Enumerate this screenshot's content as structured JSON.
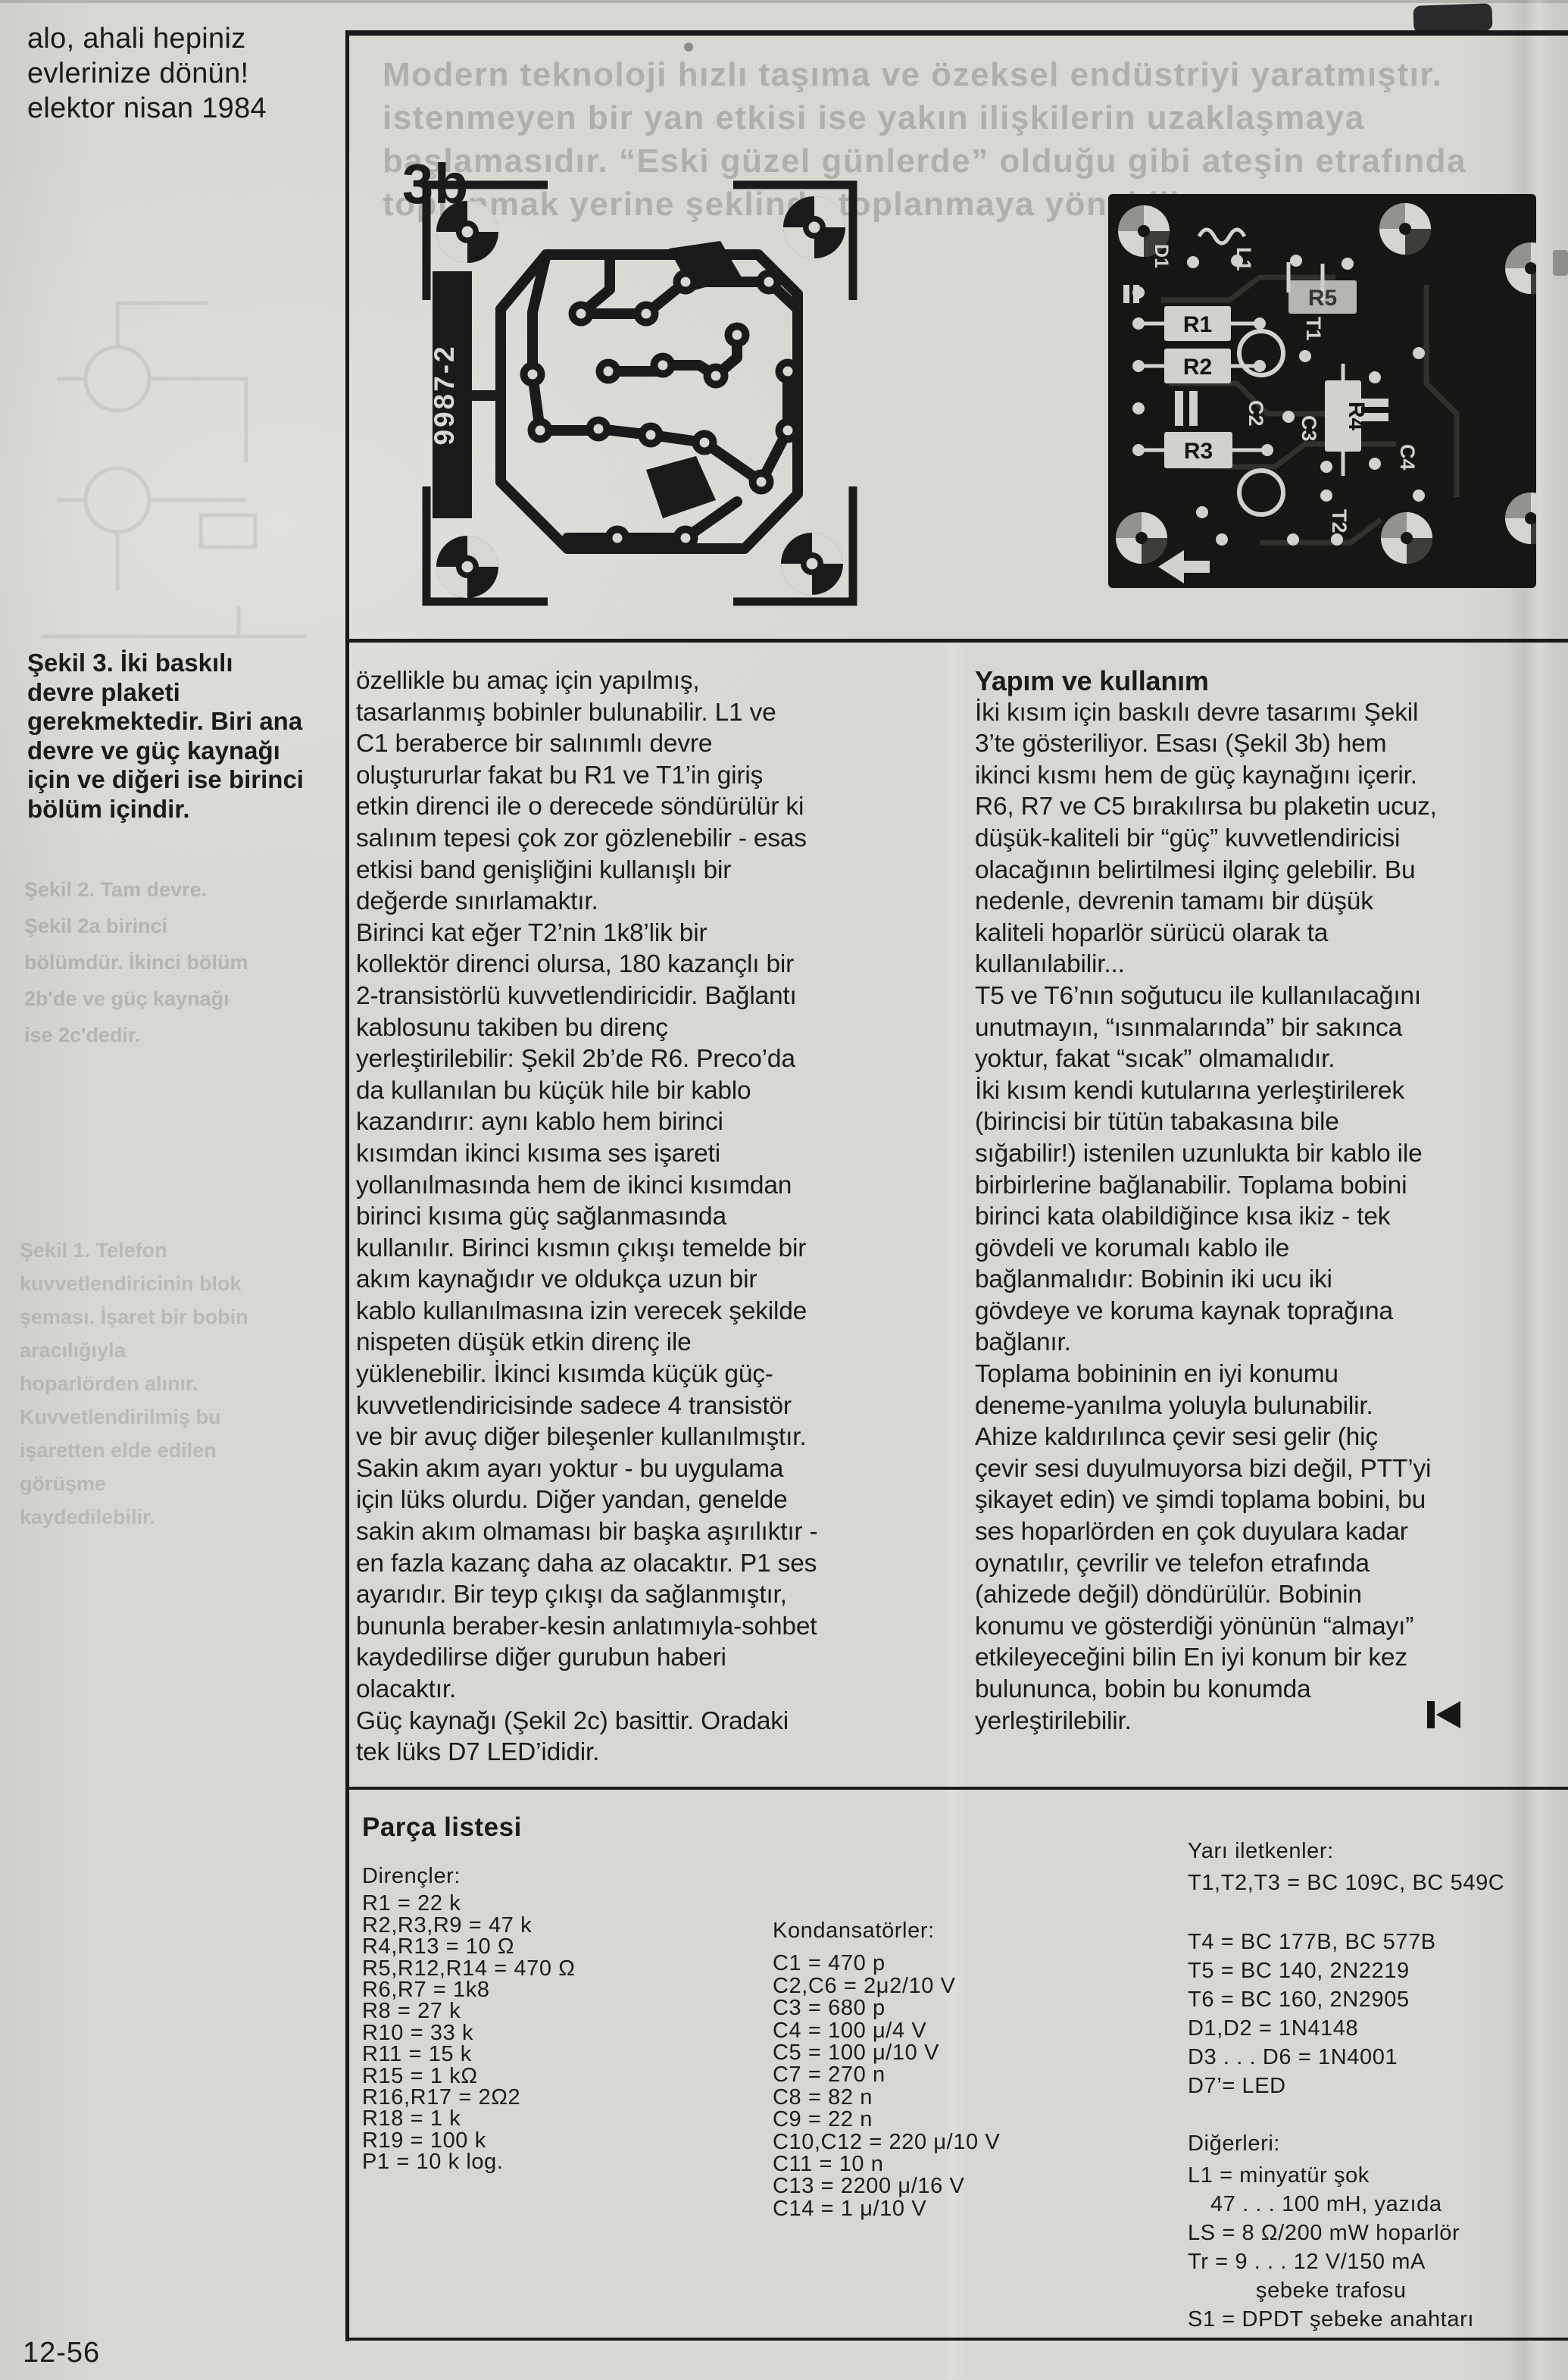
{
  "page": {
    "note_lines": [
      "alo, ahali hepiniz",
      "evlerinize dönün!",
      "elektor nisan 1984"
    ],
    "page_number": "12-56"
  },
  "ghost": {
    "top_lines": [
      "Modern teknoloji hızlı taşıma ve özeksel endüstriyi yaratmıştır.",
      "istenmeyen bir yan etkisi ise yakın ilişkilerin uzaklaşmaya",
      "başlamasıdır. “Eski güzel günlerde” olduğu gibi ateşin etrafında",
      "toplanmak yerine şeklinde toplanmaya yöneldik"
    ],
    "side_letter": "S",
    "margin_a_lines": [
      "Şekil 2. Tam devre.",
      "Şekil 2a birinci",
      "bölümdür. İkinci bölüm",
      "2b'de ve güç kaynağı",
      "ise 2c'dedir."
    ],
    "margin_b_lines": [
      "Şekil 1. Telefon",
      "kuvvetlendiricinin blok",
      "şeması. İşaret bir bobin",
      "aracılığıyla",
      "hoparlörden alınır.",
      "Kuvvetlendirilmiş bu",
      "işaretten elde edilen",
      "görüşme",
      "kaydedilebilir."
    ]
  },
  "figure": {
    "label": "3b",
    "board_code": "9987-2",
    "photo": {
      "r1": "R1",
      "r2": "R2",
      "r3": "R3",
      "r4": "R4",
      "r5": "R5",
      "c2": "C2",
      "c3": "C3",
      "c4": "C4",
      "t1": "T1",
      "t2": "T2",
      "l1": "L1",
      "d1": "D1"
    },
    "caption_lines": [
      "Şekil 3. İki baskılı",
      "devre plaketi",
      "gerekmektedir. Biri ana",
      "devre ve güç kaynağı",
      "için ve diğeri ise birinci",
      "bölüm içindir."
    ]
  },
  "article": {
    "col1_lines": [
      "özellikle bu amaç için yapılmış,",
      "tasarlanmış bobinler bulunabilir. L1 ve",
      "C1 beraberce bir salınımlı devre",
      "oluştururlar fakat bu R1 ve T1’in giriş",
      "etkin direnci ile o derecede söndürülür ki",
      "salınım tepesi çok zor gözlenebilir - esas",
      "etkisi band genişliğini kullanışlı bir",
      "değerde sınırlamaktır.",
      "Birinci kat eğer T2’nin 1k8’lik bir",
      "kollektör direnci olursa, 180 kazançlı bir",
      "2-transistörlü kuvvetlendiricidir. Bağlantı",
      "kablosunu takiben bu direnç",
      "yerleştirilebilir: Şekil 2b’de R6. Preco’da",
      "da kullanılan bu küçük hile bir kablo",
      "kazandırır: aynı kablo hem birinci",
      "kısımdan ikinci kısıma ses işareti",
      "yollanılmasında hem de ikinci kısımdan",
      "birinci kısıma güç sağlanmasında",
      "kullanılır. Birinci kısmın çıkışı temelde bir",
      "akım kaynağıdır ve oldukça uzun bir",
      "kablo kullanılmasına izin verecek şekilde",
      "nispeten düşük etkin direnç ile",
      "yüklenebilir. İkinci kısımda küçük güç-",
      "kuvvetlendiricisinde sadece 4 transistör",
      "ve bir avuç diğer bileşenler kullanılmıştır.",
      "Sakin akım ayarı yoktur - bu uygulama",
      "için lüks olurdu. Diğer yandan, genelde",
      "sakin akım olmaması bir başka aşırılıktır -",
      "en fazla kazanç daha az olacaktır. P1 ses",
      "ayarıdır. Bir teyp çıkışı da sağlanmıştır,",
      "bununla beraber-kesin anlatımıyla-sohbet",
      "kaydedilirse diğer gurubun haberi",
      "olacaktır.",
      "Güç kaynağı (Şekil 2c) basittir. Oradaki",
      "tek lüks D7 LED’ididir."
    ],
    "col2_heading": "Yapım ve kullanım",
    "col2_lines": [
      "İki kısım için baskılı devre tasarımı Şekil",
      "3’te gösteriliyor. Esası (Şekil 3b) hem",
      "ikinci kısmı hem de güç kaynağını içerir.",
      "R6, R7 ve C5 bırakılırsa bu plaketin ucuz,",
      "düşük-kaliteli bir “güç” kuvvetlendiricisi",
      "olacağının belirtilmesi ilginç gelebilir. Bu",
      "nedenle, devrenin tamamı bir düşük",
      "kaliteli hoparlör sürücü olarak ta",
      "kullanılabilir...",
      "T5 ve T6’nın soğutucu ile kullanılacağını",
      "unutmayın, “ısınmalarında” bir sakınca",
      "yoktur, fakat “sıcak” olmamalıdır.",
      "İki kısım kendi kutularına yerleştirilerek",
      "(birincisi bir tütün tabakasına bile",
      "sığabilir!) istenilen uzunlukta bir kablo ile",
      "birbirlerine bağlanabilir. Toplama bobini",
      "birinci kata olabildiğince kısa ikiz - tek",
      "gövdeli ve korumalı kablo ile",
      "bağlanmalıdır: Bobinin iki ucu iki",
      "gövdeye ve koruma kaynak toprağına",
      "bağlanır.",
      "Toplama bobininin en iyi konumu",
      "deneme-yanılma yoluyla bulunabilir.",
      "Ahize kaldırılınca çevir sesi gelir (hiç",
      "çevir sesi duyulmuyorsa bizi değil, PTT’yi",
      "şikayet edin) ve şimdi toplama bobini, bu",
      "ses hoparlörden en çok duyulara kadar",
      "oynatılır, çevrilir ve telefon etrafında",
      "(ahizede değil) döndürülür. Bobinin",
      "konumu ve gösterdiği yönünün “almayı”",
      "etkileyeceğini bilin En iyi konum bir kez",
      "bulununca, bobin bu konumda",
      "yerleştirilebilir."
    ]
  },
  "parts": {
    "title": "Parça listesi",
    "resistors_heading": "Dirençler:",
    "resistors": [
      "R1 = 22 k",
      "R2,R3,R9 = 47 k",
      "R4,R13 = 10 Ω",
      "R5,R12,R14 = 470 Ω",
      "R6,R7 = 1k8",
      "R8 = 27 k",
      "R10 = 33 k",
      "R11 = 15 k",
      "R15 = 1 kΩ",
      "R16,R17 = 2Ω2",
      "R18 = 1 k",
      "R19 = 100 k",
      "P1 = 10 k log."
    ],
    "capacitors_heading": "Kondansatörler:",
    "capacitors": [
      "C1 = 470 p",
      "C2,C6 = 2μ2/10 V",
      "C3 = 680 p",
      "C4 = 100 μ/4 V",
      "C5 = 100 μ/10 V",
      "C7 = 270 n",
      "C8 = 82 n",
      "C9 = 22 n",
      "C10,C12 = 220 μ/10 V",
      "C11 = 10 n",
      "C13 = 2200 μ/16 V",
      "C14 = 1 μ/10 V"
    ],
    "semiconductors_heading": "Yarı iletkenler:",
    "semiconductors_first": [
      "T1,T2,T3 = BC 109C, BC 549C"
    ],
    "semiconductors_rest": [
      "T4 = BC 177B, BC 577B",
      "T5 = BC 140, 2N2219",
      "T6 = BC 160, 2N2905",
      "D1,D2 = 1N4148",
      "D3 . . . D6 = 1N4001",
      "D7’= LED"
    ],
    "others_heading": "Diğerleri:",
    "others": [
      "L1 = minyatür şok",
      {
        "text": "47 . . . 100 mH, yazıda",
        "indent": 1
      },
      "LS = 8 Ω/200 mW hoparlör",
      "Tr = 9 . . . 12 V/150 mA",
      {
        "text": "şebeke trafosu",
        "indent": 3
      },
      "S1 = DPDT şebeke anahtarı"
    ]
  }
}
